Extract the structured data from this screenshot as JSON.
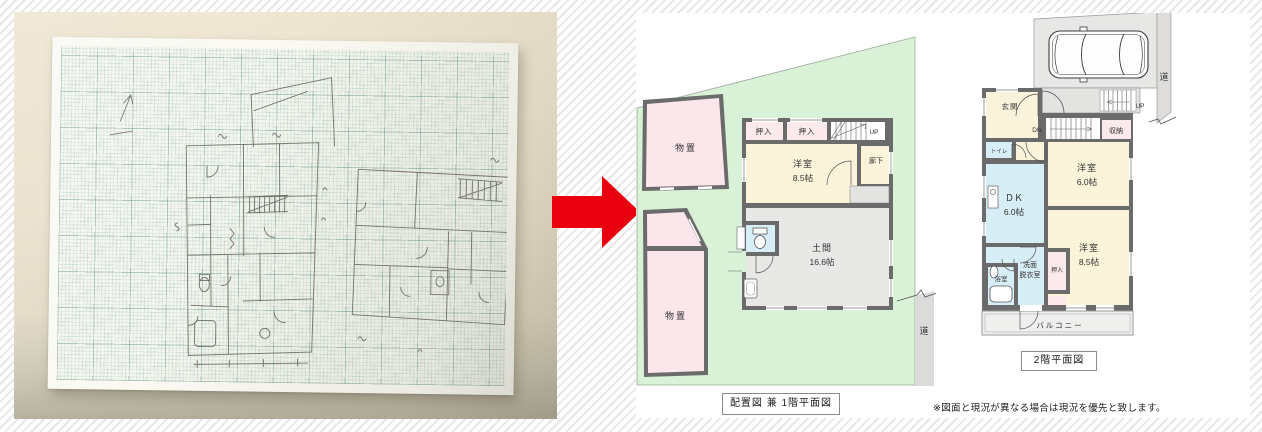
{
  "palette": {
    "site_green": "#d9f1d7",
    "room_cream": "#fbf4da",
    "closet_pink": "#fce9ec",
    "shed_pink": "#fbe7eb",
    "water_blue": "#d8eef6",
    "doma_gray": "#e8e8e6",
    "wall_gray": "#6b6b6b",
    "road_gray": "#dbdbd9",
    "arrow_red": "#e8000f"
  },
  "icons": {
    "transform_arrow": "right-arrow",
    "car": "car-top-view",
    "north_arrow": "north-arrow"
  },
  "plan1": {
    "caption": "配置図 兼 1階平面図",
    "road_label": "道",
    "sheds": [
      "物置",
      "物置"
    ],
    "closets": [
      "押入",
      "押入"
    ],
    "stairs_label": "UP",
    "corridor_label": "廊下",
    "rooms": [
      {
        "name": "洋室",
        "size": "8.5帖"
      },
      {
        "name": "土間",
        "size": "16.6帖"
      }
    ]
  },
  "plan2": {
    "caption": "2階平面図",
    "road_label": "道",
    "entrance_label": "玄関",
    "stairs_up_label": "UP",
    "stairs_down_label": "DN",
    "storage_label": "収納",
    "toilet_label": "トイレ",
    "closet_label": "押入",
    "bath_label": "浴室",
    "balcony_label": "バルコニー",
    "washroom_label_line1": "洗面",
    "washroom_label_line2": "脱衣室",
    "rooms": [
      {
        "name": "洋室",
        "size": "6.0帖"
      },
      {
        "name": "ＤＫ",
        "size": "6.0帖"
      },
      {
        "name": "洋室",
        "size": "8.5帖"
      }
    ]
  },
  "footer_note": "※図面と現況が異なる場合は現況を優先と致します。"
}
